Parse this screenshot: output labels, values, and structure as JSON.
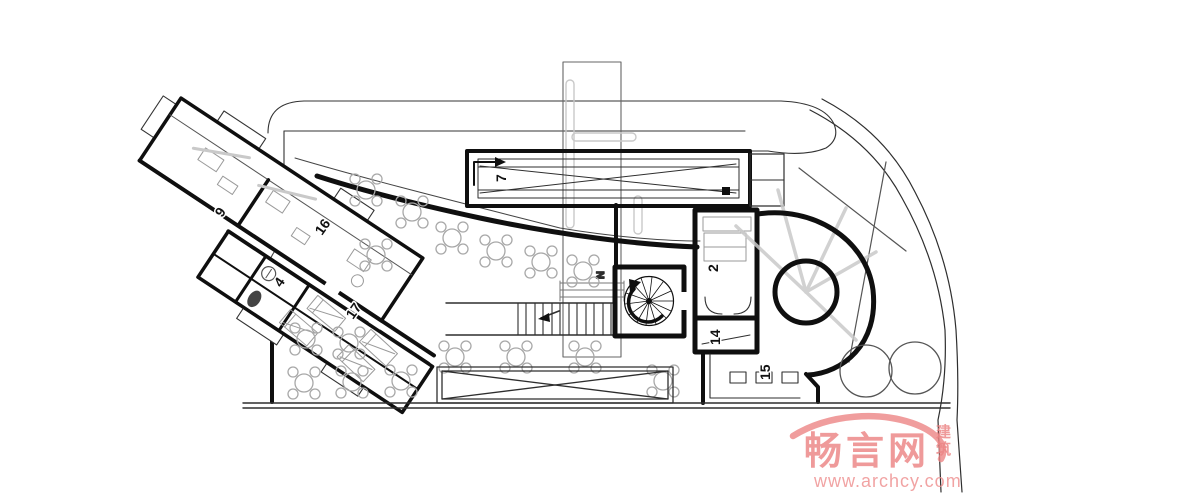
{
  "watermark": {
    "brand": "畅言网",
    "badge_top": "建",
    "badge_bottom": "筑",
    "url": "www.archcy.com",
    "color": "#ec8585",
    "url_color": "#ef9494"
  },
  "plan": {
    "labels": {
      "room9": "9",
      "room16": "16",
      "room17": "17",
      "room4": "4",
      "ramp": "7",
      "north": "N",
      "room2": "2",
      "room14": "14",
      "room15": "15"
    }
  },
  "colors": {
    "wall": "#0f0f0f",
    "thin_line": "#2e2e2e",
    "structure": "#c9c9c9",
    "furniture": "#9a9a9a"
  }
}
